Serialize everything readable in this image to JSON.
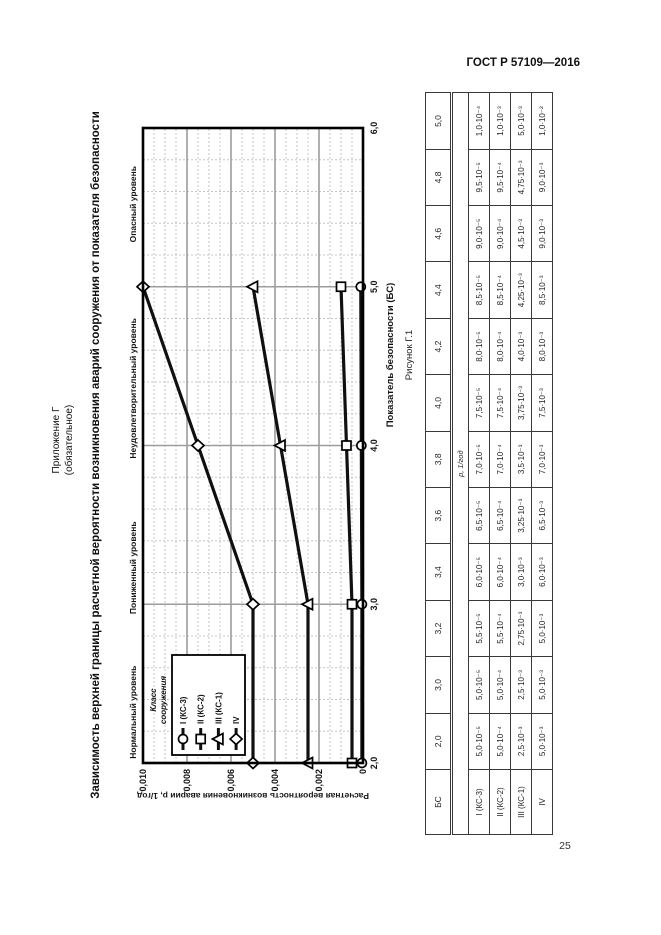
{
  "page": {
    "header": "ГОСТ Р 57109—2016",
    "page_number": "25",
    "appendix_line1": "Приложение Г",
    "appendix_line2": "(обязательное)",
    "title": "Зависимость верхней границы расчетной вероятности возникновения аварий сооружения от показателя безопасности"
  },
  "chart_data": {
    "type": "line",
    "caption": "Рисунок Г.1",
    "xlabel": "Показатель безопасности (БС)",
    "ylabel": "Расчетная вероятность возникновения аварии р, 1/год",
    "xlim": [
      2.0,
      6.0
    ],
    "ylim": [
      0,
      0.01
    ],
    "x_ticks": [
      {
        "value": 2.0,
        "label": "2,0"
      },
      {
        "value": 3.0,
        "label": "3,0"
      },
      {
        "value": 4.0,
        "label": "4,0"
      },
      {
        "value": 5.0,
        "label": "5,0"
      },
      {
        "value": 6.0,
        "label": "6,0"
      }
    ],
    "y_ticks": [
      {
        "value": 0,
        "label": "0"
      },
      {
        "value": 0.002,
        "label": "0,002"
      },
      {
        "value": 0.004,
        "label": "0,004"
      },
      {
        "value": 0.006,
        "label": "0,006"
      },
      {
        "value": 0.008,
        "label": "0,008"
      },
      {
        "value": 0.01,
        "label": "0,010"
      }
    ],
    "grid": {
      "x_minor_step": 0.2,
      "y_minor_step": 0.0005
    },
    "zone_labels": [
      {
        "label": "Нормальный уровень",
        "x_center": 2.32
      },
      {
        "label": "Пониженный уровень",
        "x_center": 3.23
      },
      {
        "label": "Неудовлетворительный уровень",
        "x_center": 4.36
      },
      {
        "label": "Опасный уровень",
        "x_center": 5.52
      }
    ],
    "legend_title": "Класс сооружения",
    "series": [
      {
        "name": "I (КС-3)",
        "marker": "circle",
        "x": [
          2.0,
          3.0,
          4.0,
          5.0
        ],
        "y": [
          5e-05,
          5e-05,
          7.5e-05,
          0.0001
        ]
      },
      {
        "name": "II (КС-2)",
        "marker": "square",
        "x": [
          2.0,
          3.0,
          4.0,
          5.0
        ],
        "y": [
          0.0005,
          0.0005,
          0.00075,
          0.001
        ]
      },
      {
        "name": "III (КС-1)",
        "marker": "triangle",
        "x": [
          2.0,
          3.0,
          4.0,
          5.0
        ],
        "y": [
          0.0025,
          0.0025,
          0.00375,
          0.005
        ]
      },
      {
        "name": "IV",
        "marker": "diamond",
        "x": [
          2.0,
          3.0,
          4.0,
          5.0
        ],
        "y": [
          0.005,
          0.005,
          0.0075,
          0.01
        ]
      }
    ]
  },
  "table": {
    "header_label": "БС",
    "columns": [
      "2,0",
      "3,0",
      "3,2",
      "3,4",
      "3,6",
      "3,8",
      "4,0",
      "4,2",
      "4,4",
      "4,6",
      "4,8",
      "5,0"
    ],
    "subheader": "р, 1/год",
    "rows": [
      {
        "label": "I (КС-3)",
        "values": [
          "5,0·10⁻⁵",
          "5,0·10⁻⁵",
          "5,5·10⁻⁵",
          "6,0·10⁻⁵",
          "6,5·10⁻⁵",
          "7,0·10⁻⁵",
          "7,5·10⁻⁵",
          "8,0·10⁻⁵",
          "8,5·10⁻⁵",
          "9,0·10⁻⁵",
          "9,5·10⁻⁵",
          "1,0·10⁻⁴"
        ]
      },
      {
        "label": "II (КС-2)",
        "values": [
          "5,0·10⁻⁴",
          "5,0·10⁻⁴",
          "5,5·10⁻⁴",
          "6,0·10⁻⁴",
          "6,5·10⁻⁴",
          "7,0·10⁻⁴",
          "7,5·10⁻⁴",
          "8,0·10⁻⁴",
          "8,5·10⁻⁴",
          "9,0·10⁻⁴",
          "9,5·10⁻⁴",
          "1,0·10⁻³"
        ]
      },
      {
        "label": "III (КС-1)",
        "values": [
          "2,5·10⁻³",
          "2,5·10⁻³",
          "2,75·10⁻³",
          "3,0·10⁻³",
          "3,25·10⁻³",
          "3,5·10⁻³",
          "3,75·10⁻³",
          "4,0·10⁻³",
          "4,25·10⁻³",
          "4,5·10⁻³",
          "4,75·10⁻³",
          "5,0·10⁻³"
        ]
      },
      {
        "label": "IV",
        "values": [
          "5,0·10⁻³",
          "5,0·10⁻³",
          "5,0·10⁻³",
          "6,0·10⁻³",
          "6,5·10⁻³",
          "7,0·10⁻³",
          "7,5·10⁻³",
          "8,0·10⁻³",
          "8,5·10⁻³",
          "9,0·10⁻³",
          "9,0·10⁻³",
          "1,0·10⁻²"
        ]
      }
    ]
  }
}
